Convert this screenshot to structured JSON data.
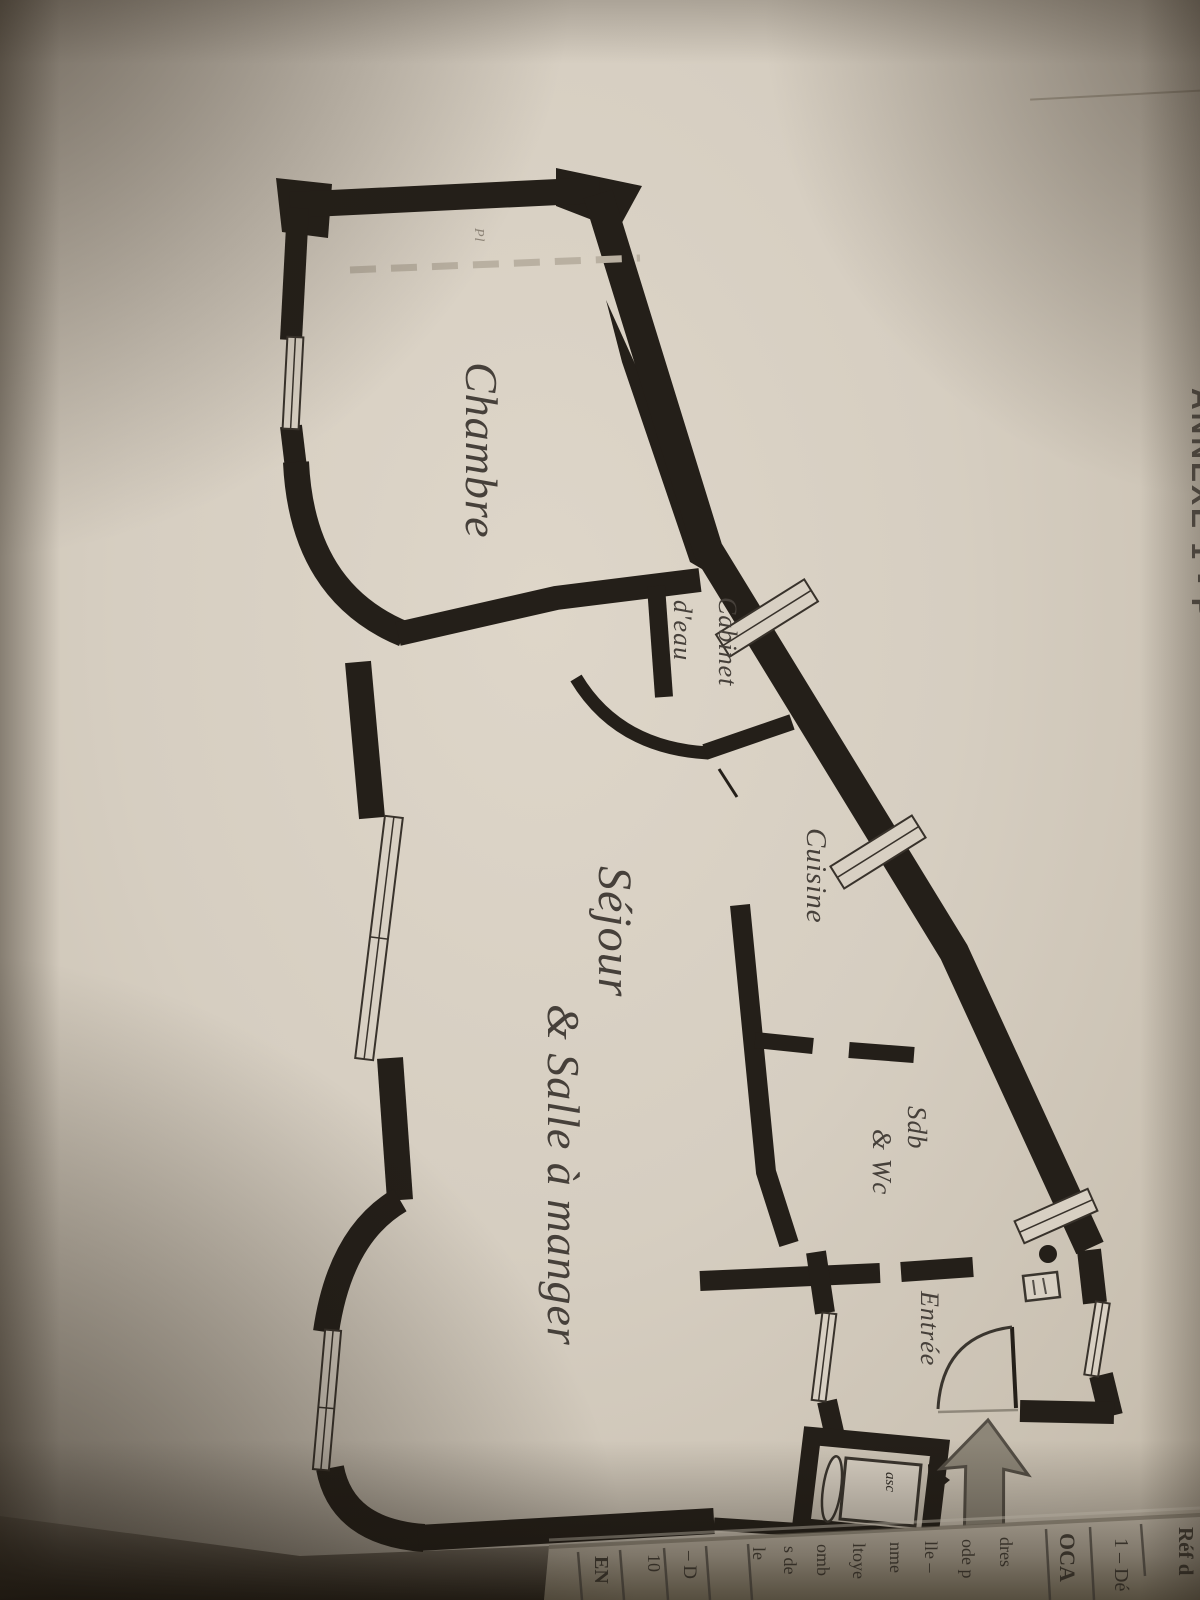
{
  "photo": {
    "description": "Photograph of a printed page showing a French apartment floor plan",
    "paper_color": "#d8d0c3",
    "ink_color": "#241f19",
    "label_color": "#46403a",
    "arrow_color": "#8d8678"
  },
  "floor_plan": {
    "rooms": [
      {
        "id": "chambre",
        "label": "Chambre"
      },
      {
        "id": "cabinet-eau",
        "line1": "Cabinet",
        "line2": "d'eau"
      },
      {
        "id": "cuisine",
        "label": "Cuisine"
      },
      {
        "id": "sejour",
        "line1": "Séjour",
        "line2": "& Salle à manger"
      },
      {
        "id": "sdb-wc",
        "line1": "Sdb",
        "line2": "& Wc"
      },
      {
        "id": "entree",
        "label": "Entrée"
      }
    ],
    "annotations": {
      "elevator": "asc",
      "closet": "Pl"
    }
  },
  "page_text": {
    "side_heading": "ANNEXE 1 - P",
    "fold_fragments": [
      {
        "text": "Réf d"
      },
      {
        "text": "1 – Dé"
      },
      {
        "text": "OCA"
      },
      {
        "text": "dres"
      },
      {
        "text": "ode p"
      },
      {
        "text": "lle –"
      },
      {
        "text": "nme"
      },
      {
        "text": "ltoye"
      },
      {
        "text": "omb"
      },
      {
        "text": "s de"
      },
      {
        "text": "le"
      },
      {
        "text": "– D"
      },
      {
        "text": "10"
      },
      {
        "text": "EN"
      }
    ]
  }
}
